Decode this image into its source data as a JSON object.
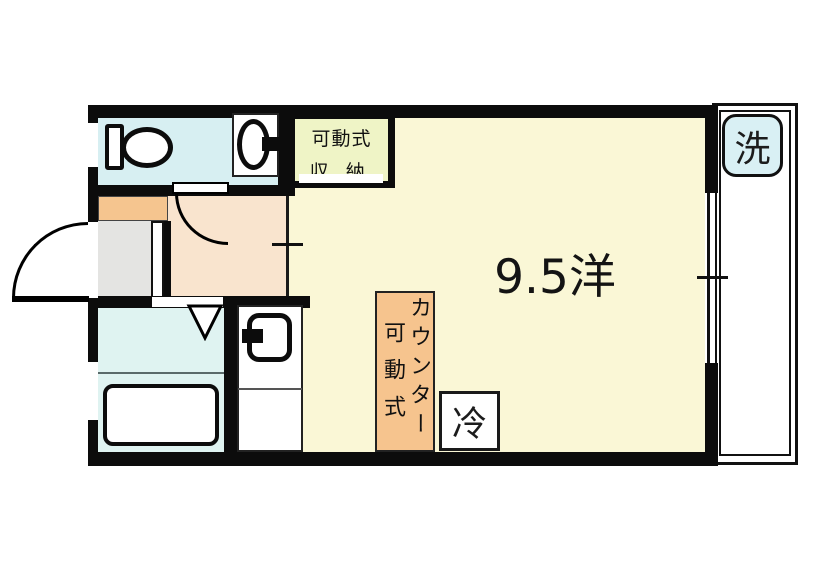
{
  "plan": {
    "title": "apartment-floor-plan",
    "rooms": {
      "main_room": {
        "label": "9.5洋"
      },
      "storage": {
        "label_line1": "可動式",
        "label_line2": "収納"
      },
      "counter": {
        "label_name": "カウンター",
        "label_type": "可動式"
      },
      "refrigerator": {
        "label": "冷"
      },
      "washing_machine": {
        "label": "洗"
      }
    },
    "colors": {
      "wall": "#0c0c0c",
      "main_room_floor": "#FAF7D6",
      "storage_fill": "#EFF4C6",
      "toilet_room_floor": "#D7EFF2",
      "bathroom_floor": "#DFF3F1",
      "washer_fill": "#D9F0F4",
      "hallway_floor": "#F9E4CE",
      "shoe_cabinet_fill": "#F5C58F",
      "counter_fill": "#F6C48E",
      "entrance_floor": "#E4E4E2",
      "fixture": "#FFFFFF"
    }
  }
}
